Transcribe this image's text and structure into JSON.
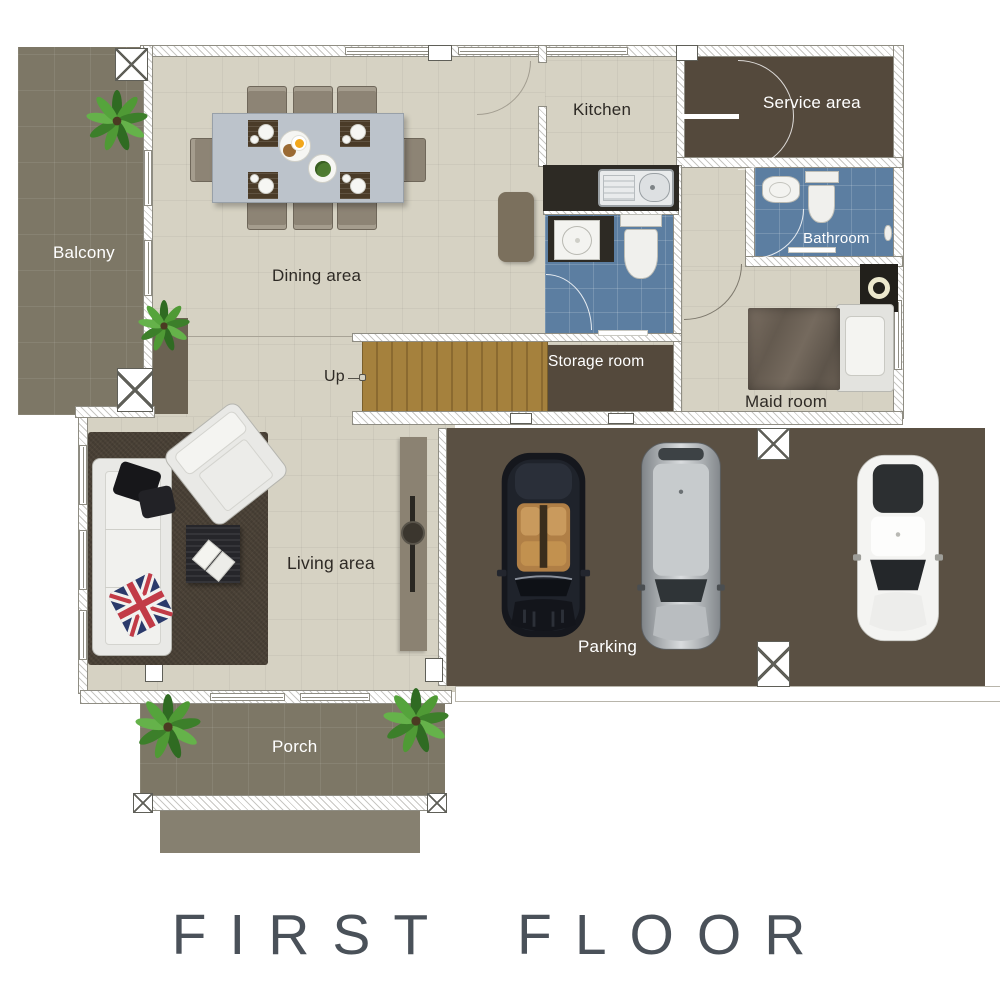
{
  "plan_title": "FIRST FLOOR",
  "rooms": {
    "balcony": "Balcony",
    "dining_area": "Dining area",
    "kitchen": "Kitchen",
    "service_area": "Service area",
    "bathroom": "Bathroom",
    "storage_room": "Storage room",
    "maid_room": "Maid room",
    "living_area": "Living area",
    "parking": "Parking",
    "porch": "Porch",
    "stairs_up": "Up"
  },
  "palette": {
    "floor_beige": "#d6d2c3",
    "outdoor_olive": "#7d7766",
    "room_dark_brown": "#54493c",
    "parking_brown": "#5a5043",
    "bathroom_blue": "#5c7ea1",
    "stair_wood": "#a5813d",
    "label_dark": "#2e2a25",
    "label_light": "#ffffff",
    "title_color": "#4a5159"
  },
  "objects": {
    "dining_chairs": 8,
    "cars": 3,
    "plants": 4,
    "items": [
      "dining-table",
      "place-settings",
      "kitchen-counter-with-sink",
      "sideboard-cabinet",
      "guest-toilet",
      "guest-washbasin",
      "bathroom-washbasin",
      "toilet",
      "washing-machine",
      "single-bed",
      "staircase",
      "sofa",
      "throw-pillows",
      "union-jack-pillow",
      "armchair",
      "coffee-table",
      "open-book",
      "area-rug",
      "tv-console",
      "convertible-car",
      "suv-car",
      "sedan-car",
      "porch-steps"
    ]
  }
}
